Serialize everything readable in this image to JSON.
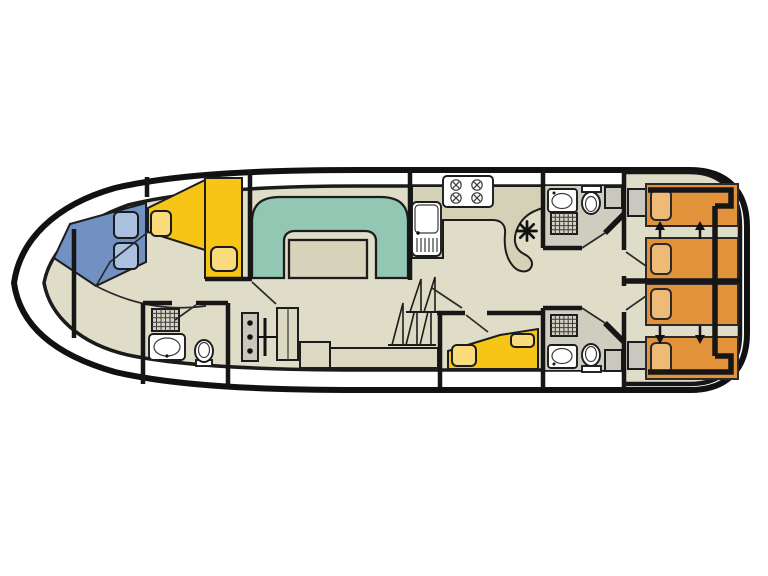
{
  "title": "Houseboat deck floor plan",
  "description": "Top-down floor plan of a canal cruiser: pointed bow at left with V-berth cabin and ensuite, central saloon with U-shaped dinette and helm, galley with stove and sink, two bathrooms, mid cabin with double bed, and aft cabins with four convertible single beds",
  "colors": {
    "background": "#ffffff",
    "outline": "#161616",
    "floor": "#dfdcc7",
    "floor_wet": "#cfcdc0",
    "dinette": "#92c7b3",
    "table": "#d8d4bc",
    "bed_blue": "#7291c3",
    "pillow_blue": "#abc0de",
    "bed_yellow": "#f6c516",
    "pillow_yellow": "#fbdc7d",
    "bed_orange": "#e3923c",
    "pillow_orange": "#efb976",
    "furniture": "#dcd9c2",
    "counter": "#d5d1b6",
    "cabinet_gray": "#c9c8bf",
    "fixture_white": "#ffffff"
  },
  "inventory": {
    "bow_cabin": [
      "blue-single-berth",
      "yellow-single-berth",
      "yellow-wardrobe",
      "two-blue-pillows",
      "two-yellow-pillows"
    ],
    "bow_bathroom": [
      "shower",
      "washbasin",
      "toilet"
    ],
    "saloon": [
      "u-shaped-dinette",
      "table",
      "helm-console",
      "steering-wheel",
      "helm-seat",
      "bench-seat"
    ],
    "galley": [
      "sink-with-drainer",
      "stove-four-burners",
      "counter",
      "heater-symbol",
      "companionway-stairs"
    ],
    "mid_cabin": [
      "yellow-double-bed",
      "two-pillows"
    ],
    "aft_bathroom_top": [
      "washbasin",
      "toilet",
      "shower",
      "locker"
    ],
    "aft_bathroom_bottom": [
      "shower",
      "washbasin",
      "toilet",
      "locker"
    ],
    "aft_cabin_top": [
      "two-orange-single-beds",
      "slide-together-arrows",
      "locker"
    ],
    "aft_cabin_bottom": [
      "two-orange-single-beds",
      "slide-together-arrows",
      "locker"
    ],
    "bed_count_total": 8,
    "bathroom_count": 3
  }
}
